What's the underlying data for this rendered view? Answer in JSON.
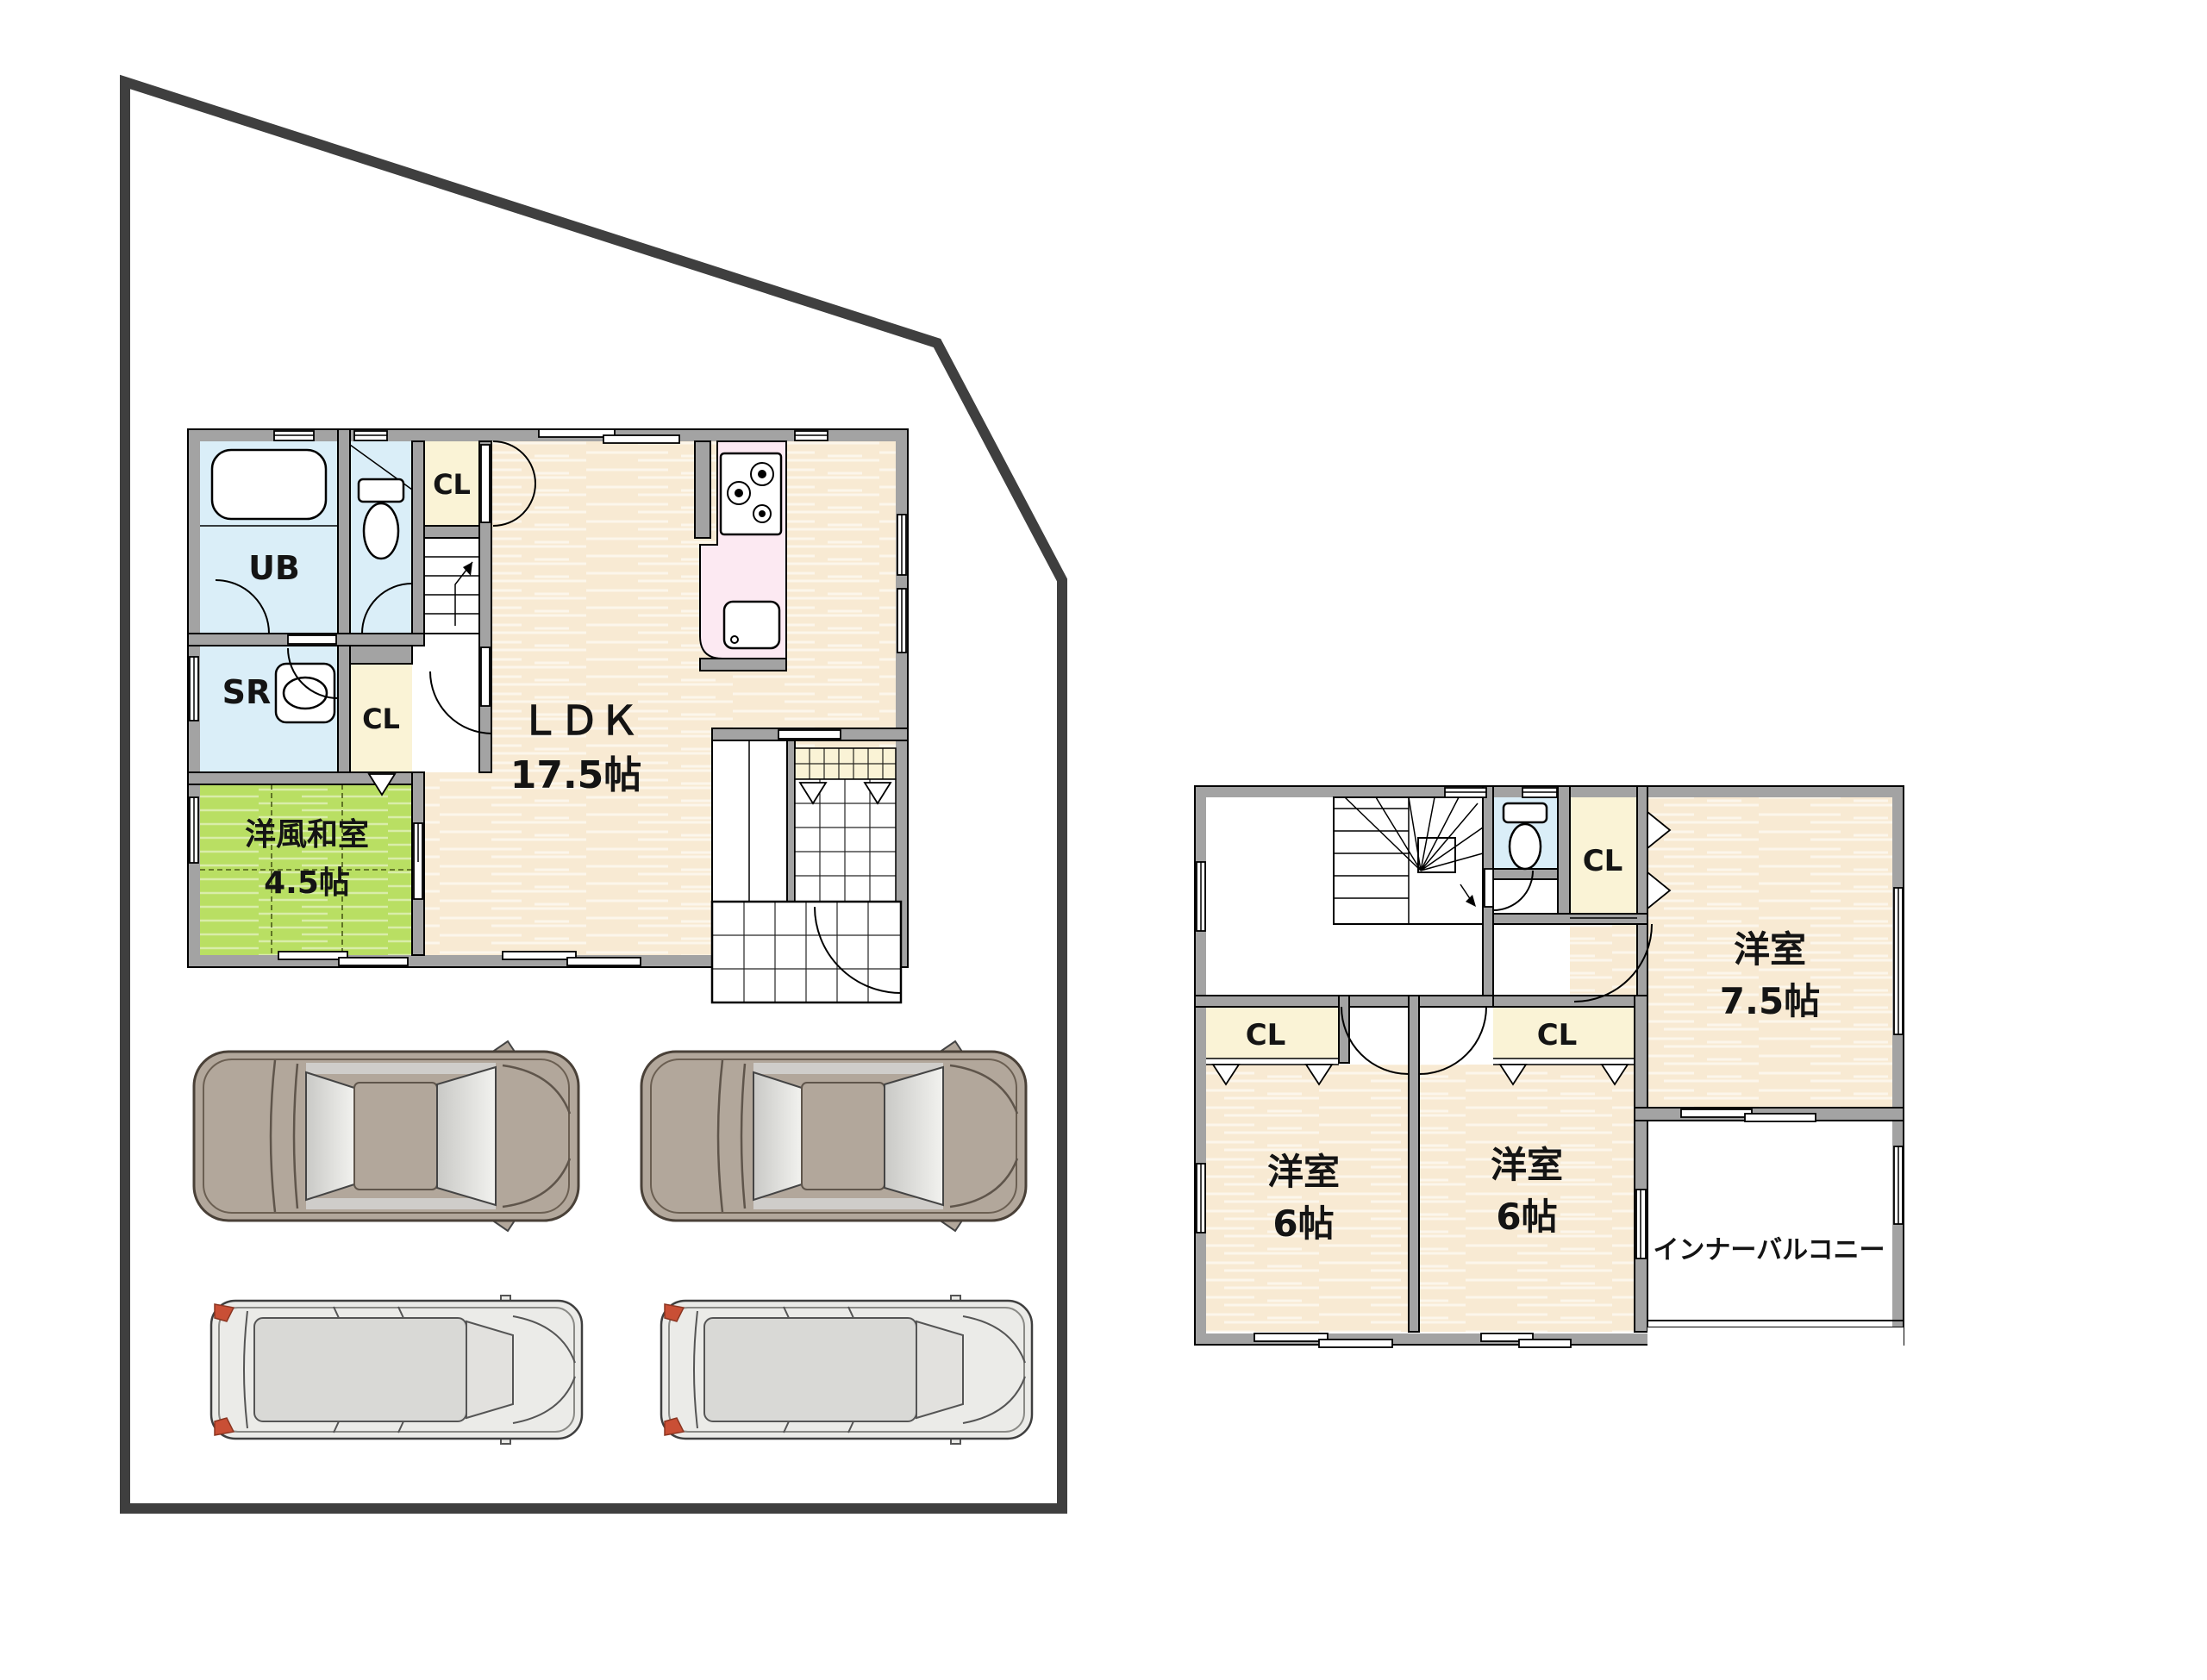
{
  "title": "residential floor plan with site and parking",
  "colors": {
    "wall": "#a3a3a3",
    "floor_beige": "#f8ead3",
    "tatami_green": "#b9df63",
    "water_blue": "#daeef8",
    "closet_cream": "#faf3d6",
    "kitchen_pink": "#fce9f2",
    "site_boundary": "#3f3f3f",
    "sedan_body": "#b2a79b",
    "minivan_body": "#ebebe8",
    "glass_gray": "#d9d9d6",
    "tail_light": "#c94f35"
  },
  "floor1": {
    "ub": "UB",
    "sr": "SR",
    "cl_a": "CL",
    "cl_b": "CL",
    "washitsu_name": "洋風和室",
    "washitsu_size": "4.5帖",
    "ldk_name": "ＬＤＫ",
    "ldk_size": "17.5帖"
  },
  "floor2": {
    "cl_top": "CL",
    "cl_left": "CL",
    "cl_mid": "CL",
    "room75_name": "洋室",
    "room75_size": "7.5帖",
    "room6a_name": "洋室",
    "room6a_size": "6帖",
    "room6b_name": "洋室",
    "room6b_size": "6帖",
    "balcony": "インナーバルコニー"
  }
}
